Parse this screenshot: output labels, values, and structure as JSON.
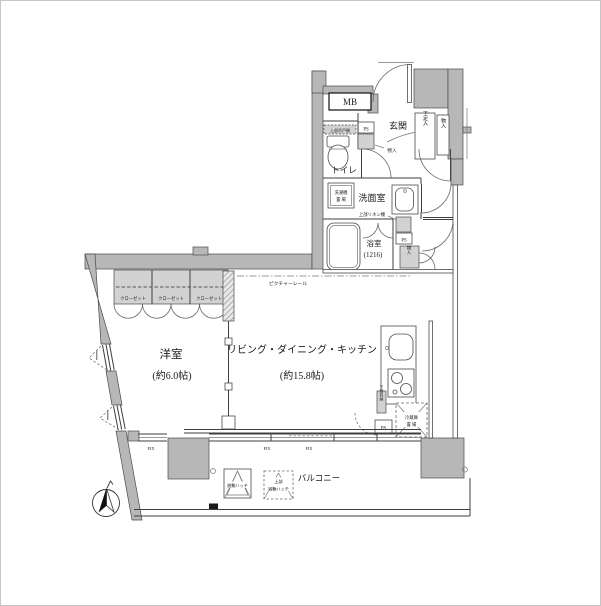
{
  "canvas": {
    "width": 601,
    "height": 606
  },
  "colors": {
    "wall_fill": "#b7b7b7",
    "line": "#3f3f3f",
    "shade_fill": "#d2d2d2",
    "background": "#ffffff"
  },
  "rooms": {
    "ldk": {
      "name": "リビング・ダイニング・キッチン",
      "size": "(約15.8帖)"
    },
    "bedroom": {
      "name": "洋室",
      "size": "(約6.0帖)"
    },
    "entrance": {
      "name": "玄関"
    },
    "toilet": {
      "name": "トイレ"
    },
    "washroom": {
      "name": "洗面室"
    },
    "bathroom": {
      "name": "浴室",
      "size": "(1216)"
    },
    "balcony": {
      "name": "バルコニー"
    }
  },
  "fixtures": {
    "meter_box": "MB",
    "pipe_space": "PS",
    "closet": "クローゼット",
    "shoe_cabinet": "下足入",
    "storage": "物入",
    "upper_cabinet": "上部吊戸棚",
    "washer_space": {
      "line1": "洗濯機",
      "line2": "置 場"
    },
    "upper_linen_shelf": "上部リネン棚",
    "under_counter_storage": "下部収納",
    "fridge_space": {
      "line1": "冷蔵庫",
      "line2": "置 場"
    },
    "picture_rail": "ピクチャーレール",
    "fixed_window": "FIX",
    "escape_hatch": "避難ハッチ",
    "upper_escape_hatch": {
      "line1": "上部",
      "line2": "避難ハッチ"
    }
  }
}
